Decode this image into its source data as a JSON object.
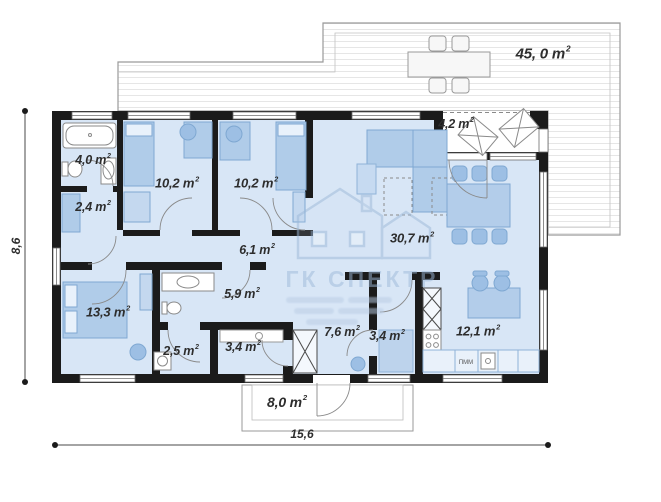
{
  "watermark": {
    "title": "ГК СПЕКТР"
  },
  "units": {
    "meter": " m",
    "sup": "2"
  },
  "dimensions": {
    "width": "15,6",
    "height": "8,6"
  },
  "rooms": {
    "terrace_top": {
      "area": "45, 0"
    },
    "porch": {
      "area": "4,2"
    },
    "bathroom_top": {
      "area": "4,0"
    },
    "hall_small": {
      "area": "2,4"
    },
    "bedroom_1": {
      "area": "10,2"
    },
    "bedroom_2": {
      "area": "10,2"
    },
    "hallway": {
      "area": "6,1"
    },
    "living_room": {
      "area": "30,7"
    },
    "bedroom_3": {
      "area": "13,3"
    },
    "bathroom_2": {
      "area": "5,9"
    },
    "closet": {
      "area": "2,5"
    },
    "laundry": {
      "area": "3,4"
    },
    "corridor": {
      "area": "7,6"
    },
    "wardrobe": {
      "area": "3,4"
    },
    "kitchen": {
      "area": "12,1"
    },
    "terrace_bottom": {
      "area": "8,0"
    }
  },
  "kitchen_labels": {
    "dishwasher": "ПММ"
  },
  "colors": {
    "wall": "#1b1b1b",
    "room_fill": "#d8e6f6",
    "furniture": "#b0cce9",
    "watermark": "#9db9d9"
  }
}
